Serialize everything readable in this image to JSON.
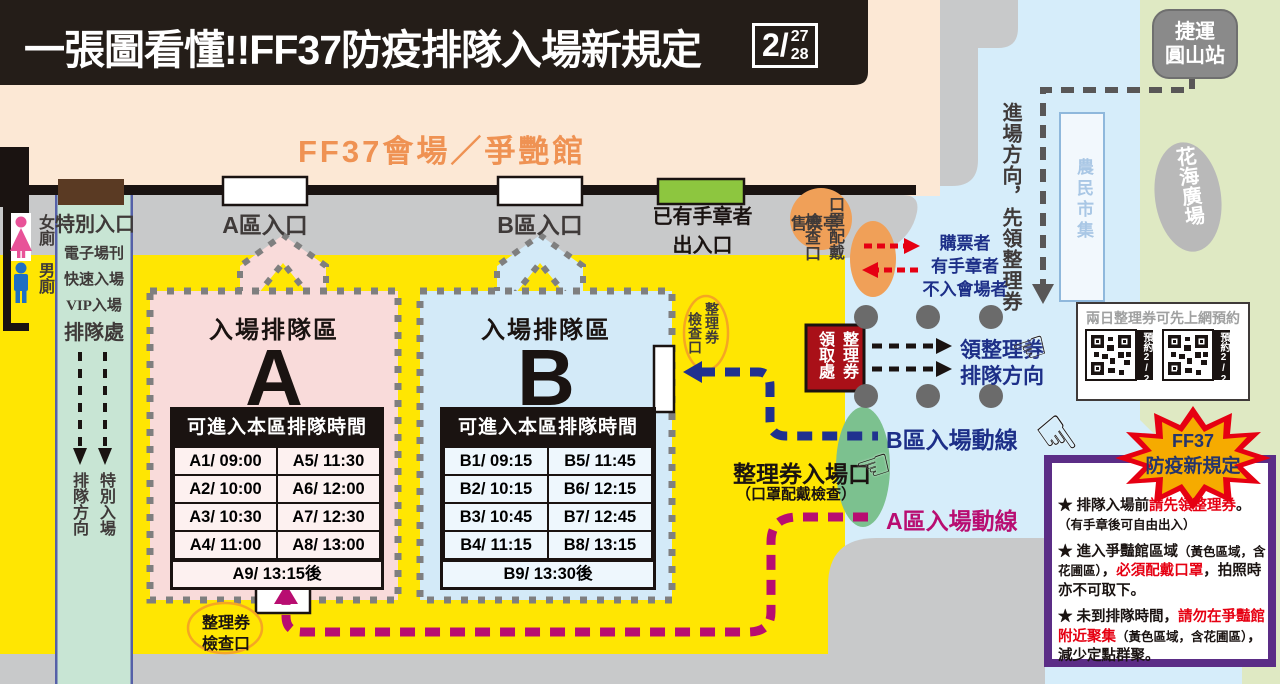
{
  "colors": {
    "yellow": "#ffe602",
    "peach": "#fce8d5",
    "road_blue": "#d6edfa",
    "park_green": "#dfe9c3",
    "walkway_gray": "#c8c9ca",
    "pink_zone": "#f9dbda",
    "blue_zone": "#d3eaf8",
    "green_lane": "#c8e5d4",
    "navy": "#1d2f88",
    "magenta": "#b80d71",
    "red": "#e60012",
    "purple": "#5b2d86",
    "orange": "#f0a058",
    "dark_red": "#a91018",
    "gate_green": "#7cc18f",
    "door_green": "#8dc63f"
  },
  "banner": {
    "title": "一張圖看懂!!FF37防疫排隊入場新規定",
    "date_month": "2/",
    "date_day1": "27",
    "date_day2": "28"
  },
  "venue": {
    "label": "FF37會場／爭艷館"
  },
  "map": {
    "mrt_line1": "捷運",
    "mrt_line2": "圓山站",
    "flower_plaza": "花海廣場",
    "farmers_market": "農民市集",
    "approach_note": "進場方向，先領整理券",
    "ticket_booth": "售票亭",
    "toilet_female": "女廁",
    "toilet_male": "男廁"
  },
  "entrances": {
    "special": {
      "label": "特別入口",
      "line1": "電子場刊",
      "line2": "快速入場",
      "line3": "VIP入場",
      "line4": "排隊處",
      "flow_left": "排隊方向",
      "flow_right": "特別入場"
    },
    "a_label": "A區入口",
    "b_label": "B區入口",
    "stamped_line1": "已有手章者",
    "stamped_line2": "出入口"
  },
  "checkpoints": {
    "mask_col_right": "口罩配戴",
    "mask_col_left": "檢查口",
    "voucher_check_b_right": "整理券",
    "voucher_check_b_left": "檢查口",
    "voucher_pickup_right": "整理券",
    "voucher_pickup_left": "領取處",
    "voucher_check_a_line1": "整理券",
    "voucher_check_a_line2": "檢查口",
    "voucher_gate": "整理券入場口",
    "voucher_gate_sub": "（口罩配戴檢查）"
  },
  "flows": {
    "visitors": [
      "購票者",
      "有手章者",
      "不入會場者"
    ],
    "get_voucher_line1": "領整理券",
    "get_voucher_line2": "排隊方向",
    "route_b": "B區入場動線",
    "route_a": "A區入場動線"
  },
  "queue_a": {
    "title": "入場排隊區",
    "letter": "A",
    "table_header": "可進入本區排隊時間",
    "rows": [
      [
        "A1/ 09:00",
        "A5/ 11:30"
      ],
      [
        "A2/ 10:00",
        "A6/ 12:00"
      ],
      [
        "A3/ 10:30",
        "A7/ 12:30"
      ],
      [
        "A4/ 11:00",
        "A8/ 13:00"
      ]
    ],
    "last_row": "A9/ 13:15後"
  },
  "queue_b": {
    "title": "入場排隊區",
    "letter": "B",
    "table_header": "可進入本區排隊時間",
    "rows": [
      [
        "B1/ 09:15",
        "B5/ 11:45"
      ],
      [
        "B2/ 10:15",
        "B6/ 12:15"
      ],
      [
        "B3/ 10:45",
        "B7/ 12:45"
      ],
      [
        "B4/ 11:15",
        "B8/ 13:15"
      ]
    ],
    "last_row": "B9/ 13:30後"
  },
  "qr_panel": {
    "title": "兩日整理券可先上網預約",
    "label1": "預約2/27",
    "label2": "預約2/28"
  },
  "starburst": {
    "line1": "FF37",
    "line2": "防疫新規定"
  },
  "rules": {
    "r1a": "★ 排隊入場前",
    "r1b": "請先領整理券",
    "r1c": "。",
    "r1d": "（有手章後可自由出入）",
    "r2a": "★ 進入爭豔館區域",
    "r2b": "（黃色區域，含花圃區）",
    "r2c": "，",
    "r2d": "必須配戴口罩",
    "r2e": "，拍照時亦不可取下。",
    "r3a": "★ 未到排隊時間，",
    "r3b": "請勿在爭豔館附近聚集",
    "r3c": "（黃色區域，含花圃區）",
    "r3d": "，減少定點群聚。"
  }
}
